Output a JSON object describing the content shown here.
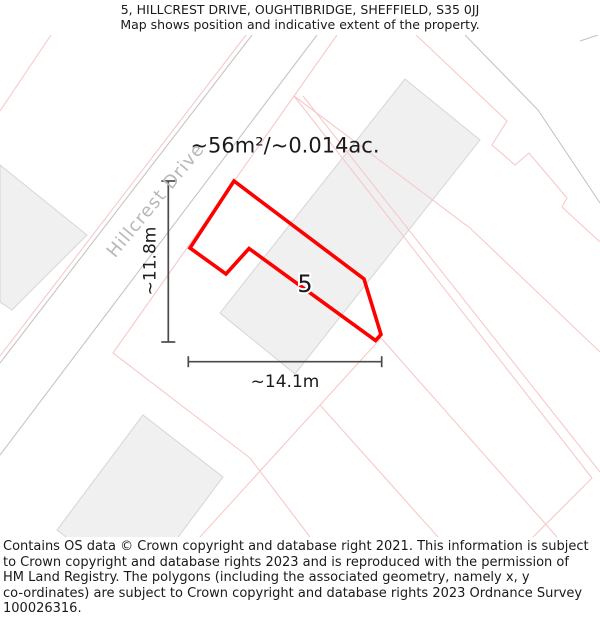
{
  "header": {
    "title": "5, HILLCREST DRIVE, OUGHTIBRIDGE, SHEFFIELD, S35 0JJ",
    "subtitle": "Map shows position and indicative extent of the property."
  },
  "map": {
    "area_label": "~56m²/~0.014ac.",
    "plot_number": "5",
    "street_label": "Hillcrest Drive",
    "dim_width_label": "~14.1m",
    "dim_height_label": "~11.8m",
    "colors": {
      "plot_outline": "#ff0000",
      "parcel_line": "#f8c8c8",
      "road_line": "#c5c5c5",
      "building_fill": "#f0f0f0",
      "building_stroke": "#d5d5d5",
      "dimension": "#4a4a4a",
      "street_text": "#b8b8b8",
      "text": "#1a1a1a"
    },
    "geometry": {
      "plot_polygon": [
        [
          234,
          181
        ],
        [
          190,
          248
        ],
        [
          226,
          274
        ],
        [
          249,
          248.5
        ],
        [
          375.5,
          340.5
        ],
        [
          381,
          334.5
        ],
        [
          364,
          279
        ]
      ],
      "buildings": [
        {
          "name": "building-left",
          "points": [
            [
              0,
              165
            ],
            [
              87,
              235
            ],
            [
              12,
              310
            ],
            [
              0,
              302
            ]
          ]
        },
        {
          "name": "building-terrace",
          "points": [
            [
              405,
              79
            ],
            [
              480,
              140
            ],
            [
              295,
              374
            ],
            [
              220,
              313
            ]
          ]
        },
        {
          "name": "building-bottom",
          "points": [
            [
              143,
              415
            ],
            [
              223,
              477
            ],
            [
              137,
              592
            ],
            [
              57,
              530
            ]
          ]
        }
      ],
      "road_lines": [
        {
          "name": "hillcrest-drive-left-edge",
          "points": [
            [
              252,
              35
            ],
            [
              0,
              363
            ]
          ]
        },
        {
          "name": "hillcrest-drive-right-edge",
          "points": [
            [
              317,
              35
            ],
            [
              0,
              455
            ]
          ]
        },
        {
          "name": "right-road-edge",
          "points": [
            [
              465,
              35
            ],
            [
              538,
              110
            ],
            [
              600,
              203
            ]
          ]
        },
        {
          "name": "top-right-road-fragment",
          "points": [
            [
              580,
              41
            ],
            [
              598,
              35
            ]
          ]
        }
      ],
      "parcel_lines": [
        [
          [
            246,
            35
          ],
          [
            0,
            356
          ]
        ],
        [
          [
            337,
            35
          ],
          [
            113,
            353
          ],
          [
            250,
            458
          ],
          [
            310,
            537
          ]
        ],
        [
          [
            51,
            35
          ],
          [
            0,
            111
          ]
        ],
        [
          [
            294,
            96
          ],
          [
            592,
            478
          ],
          [
            533,
            537
          ]
        ],
        [
          [
            303,
            96
          ],
          [
            600,
            472
          ]
        ],
        [
          [
            294,
            96
          ],
          [
            470,
            228
          ],
          [
            600,
            352
          ]
        ],
        [
          [
            381,
            338
          ],
          [
            200,
            537
          ]
        ],
        [
          [
            381,
            338
          ],
          [
            557,
            537
          ]
        ],
        [
          [
            320,
            405
          ],
          [
            438,
            537
          ]
        ],
        [
          [
            416,
            35
          ],
          [
            507,
            121
          ],
          [
            492,
            145
          ],
          [
            515,
            165
          ],
          [
            529,
            153
          ],
          [
            567,
            198
          ],
          [
            562,
            207
          ],
          [
            600,
            242
          ]
        ]
      ],
      "dim_vertical": {
        "x": 168.3,
        "y1": 181,
        "y2": 342,
        "tick_half": 7
      },
      "dim_horizontal": {
        "y": 361.7,
        "x1": 188.3,
        "x2": 381.7,
        "tick_half": 5.5
      }
    }
  },
  "footer": {
    "text": "Contains OS data © Crown copyright and database right 2021. This information is subject\nto Crown copyright and database rights 2023 and is reproduced with the permission of\nHM Land Registry. The polygons (including the associated geometry, namely x, y\nco-ordinates) are subject to Crown copyright and database rights 2023 Ordnance Survey\n100026316."
  }
}
